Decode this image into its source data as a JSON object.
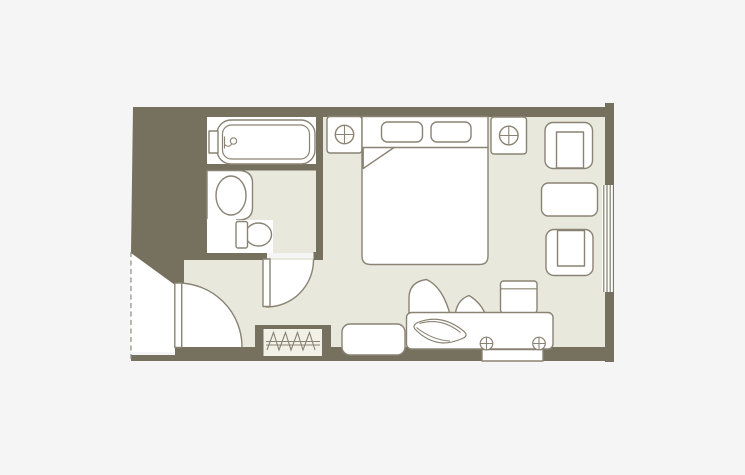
{
  "title": "hotel-guest-room-floor-plan",
  "colors": {
    "background": "#f5f5f5",
    "wall": "#76715f",
    "floor": "#e9e8dd",
    "closet": "#f2f1e8",
    "fixture": "#ffffff",
    "line": "#8a8374",
    "dashed": "#8b8b85"
  },
  "labels": {
    "plan": "Hotel guest room floor plan",
    "bathroom": "Bathroom",
    "bedroom": "Bedroom",
    "entry": "Entry hall",
    "bathtub": "Bathtub",
    "washbasin": "Washbasin counter",
    "toilet": "Toilet",
    "bed": "Double bed",
    "pillows": "Pillows",
    "blanket": "Folded blanket corner",
    "nightstand_left": "Nightstand with lamp (left of bed)",
    "nightstand_right": "Nightstand with lamp (right of bed)",
    "armchair_top": "Armchair (window side, top)",
    "armchair_bottom": "Armchair (window side, bottom)",
    "side_table": "Side table",
    "window": "Window",
    "closet": "Closet with hangers",
    "entry_door": "Entry door swing",
    "bathroom_door": "Bathroom door swing",
    "desk": "Desk / TV counter",
    "desk_item": "Decorative item on desk",
    "desk_lamps": "Desk fittings",
    "desk_drawer": "Desk drawer panel",
    "desk_chair": "Desk chair",
    "plant": "Decorative plant",
    "bench": "Luggage bench",
    "entry_boundary": "Dashed entry boundary line"
  },
  "rooms": [
    "bathroom",
    "bedroom",
    "entry-hall"
  ],
  "elements": [
    "bathtub",
    "faucet",
    "washbasin-counter",
    "basin",
    "toilet",
    "double-bed",
    "pillow-left",
    "pillow-right",
    "blanket-fold",
    "nightstand-left",
    "lamp-icon",
    "nightstand-right",
    "lamp-icon",
    "armchair-top",
    "side-table",
    "armchair-bottom",
    "window",
    "closet-hangers",
    "entry-door",
    "bathroom-door",
    "desk",
    "desk-decor",
    "desk-fitting-icon",
    "desk-fitting-icon",
    "desk-drawer",
    "desk-chair",
    "plant-petals",
    "luggage-bench",
    "entry-boundary-dashed-line"
  ]
}
